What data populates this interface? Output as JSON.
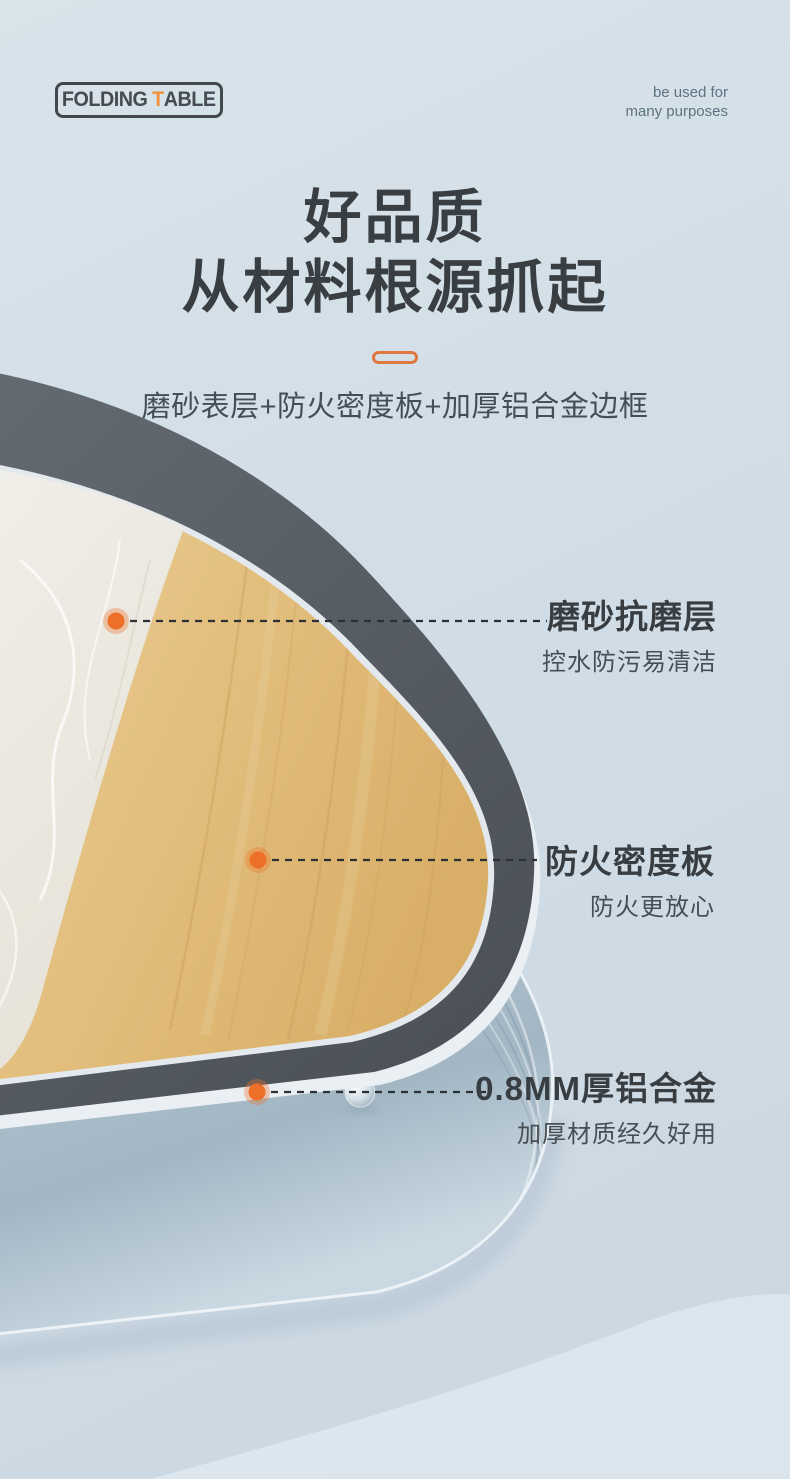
{
  "brand": {
    "logo_part1": "FOLDING",
    "logo_accent": "T",
    "logo_part2": "ABLE",
    "tagline_line1": "be used for",
    "tagline_line2": "many purposes"
  },
  "hero": {
    "title_line1": "好品质",
    "title_line2": "从材料根源抓起",
    "subtitle": "磨砂表层+防火密度板+加厚铝合金边框"
  },
  "callouts": [
    {
      "title": "磨砂抗磨层",
      "desc": "控水防污易清洁"
    },
    {
      "title": "防火密度板",
      "desc": "防火更放心"
    },
    {
      "title": "0.8MM厚铝合金",
      "desc": "加厚材质经久好用"
    }
  ],
  "colors": {
    "accent_orange": "#f1722e",
    "pill_orange": "#e0773e",
    "background_blue": "#d2dee7",
    "edge_trim_gray": "#575d64",
    "wood": "#e2bd7c",
    "marble": "#efede6",
    "aluminum": "#b7c9d5",
    "title_text": "#393e42"
  }
}
